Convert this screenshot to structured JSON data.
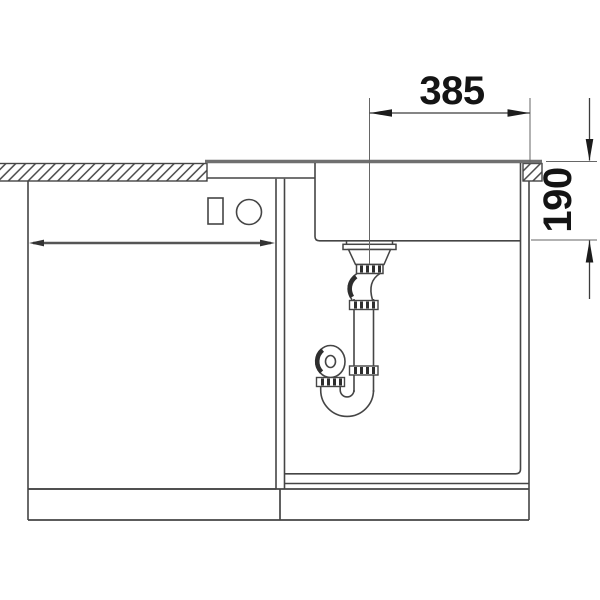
{
  "drawing": {
    "kind": "sink-installation-cross-section",
    "horizontal_dimension": "385",
    "vertical_dimension": "190"
  },
  "colors": {
    "background": "#ffffff",
    "outline": "#454545",
    "worktop_surface_line": "#6f6f6f",
    "dimension_line": "#3c3c3c",
    "dimension_text": "#141414",
    "clamp_rib": "#2e2e2e"
  }
}
